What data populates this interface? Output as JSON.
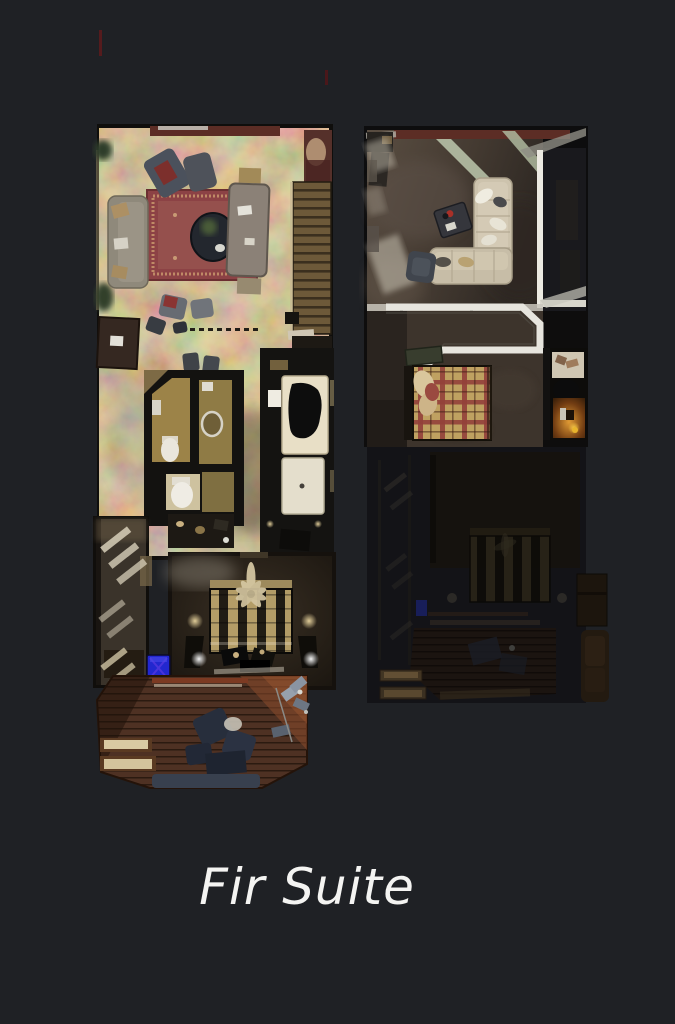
{
  "background": "#1f2125",
  "title": {
    "text": "Fir Suite",
    "color": "#f4f4f2"
  },
  "floorplans": {
    "level1": {
      "id": "level-1",
      "rooms": [
        "living-room",
        "dining-area",
        "staircase",
        "kitchen",
        "bathroom",
        "guest-bedroom",
        "master-bedroom",
        "hallway",
        "deck"
      ]
    },
    "level2": {
      "id": "level-2",
      "rooms": [
        "loft-living-room",
        "stair-void",
        "loft-bedroom",
        "bath-nook",
        "lower-level-ghost"
      ]
    }
  },
  "colors": {
    "floor-tan": "#8a744c",
    "rug-red": "#8e4347",
    "deck-wood": "#4e3123",
    "accent-blue": "#2227cf",
    "plaid-tan": "#bfa161",
    "plaid-red": "#93403a",
    "sofa-cream": "#cdc3ad",
    "railing-white": "#e7e5de",
    "wall-maroon": "#5c2d25"
  }
}
